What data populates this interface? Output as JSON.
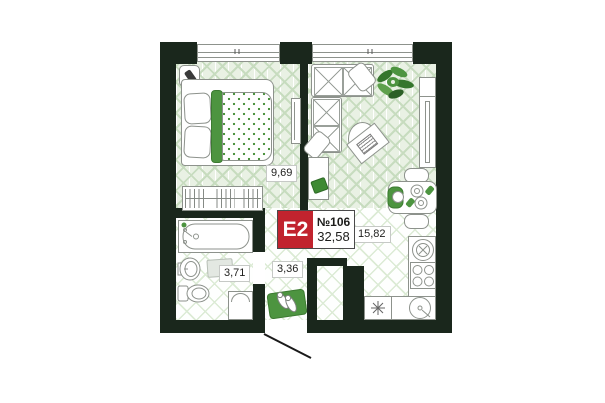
{
  "unit": {
    "type_label": "E2",
    "number": "№106",
    "total_area": "32,58"
  },
  "rooms": {
    "bedroom": {
      "area": "9,69"
    },
    "living_kitchen": {
      "area": "15,82"
    },
    "bathroom": {
      "area": "3,71"
    },
    "hallway": {
      "area": "3,36"
    }
  },
  "colors": {
    "wall": "#1a271c",
    "accent_green": "#4d9440",
    "label_red": "#c1232e",
    "floor_green": "#c7dcbf"
  }
}
